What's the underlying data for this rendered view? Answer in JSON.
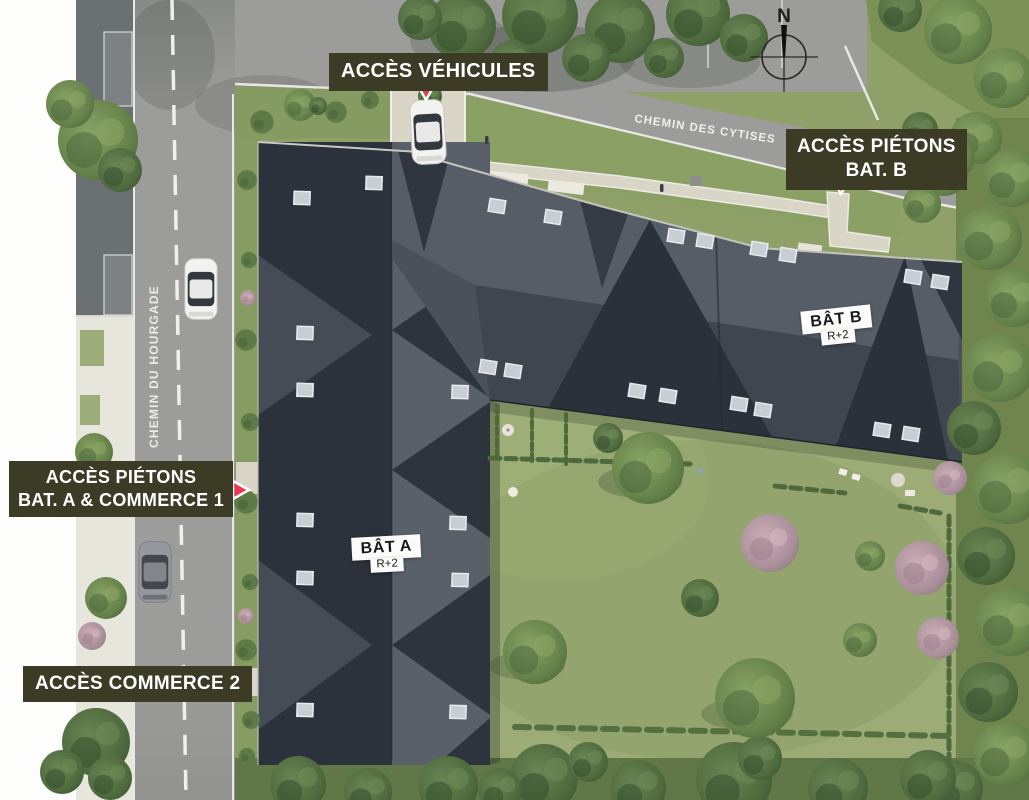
{
  "theme": {
    "label_bg": "#3b3b26",
    "label_text": "#ffffff",
    "marker_red": "#e73950",
    "roof_dark": "#2b323b",
    "roof_mid": "#4a515a",
    "roof_light": "#5a6069",
    "road_gray": "#9c9c9a",
    "grass_green": "#8fa169",
    "garden_green": "#9dac77",
    "curb_white": "#e9e9e3",
    "path_beige": "#d9d5c7",
    "building_label_bg": "#fbfbf9",
    "building_label_text": "#17191c"
  },
  "access_labels": {
    "vehicles": {
      "text": "ACCÈS VÉHICULES"
    },
    "pedestrians_b": {
      "line1": "ACCÈS PIÉTONS",
      "line2": "BAT. B"
    },
    "pedestrians_a": {
      "line1": "ACCÈS PIÉTONS",
      "line2": "BAT. A & COMMERCE 1"
    },
    "commerce_2": {
      "text": "ACCÈS COMMERCE 2"
    }
  },
  "roads": {
    "top_road_name": "CHEMIN DES CYTISES",
    "left_road_name": "CHEMIN DU HOURGADE"
  },
  "buildings": {
    "a": {
      "name": "BÂT A",
      "floors": "R+2"
    },
    "b": {
      "name": "BÂT B",
      "floors": "R+2"
    }
  },
  "compass": {
    "north_label": "N"
  }
}
